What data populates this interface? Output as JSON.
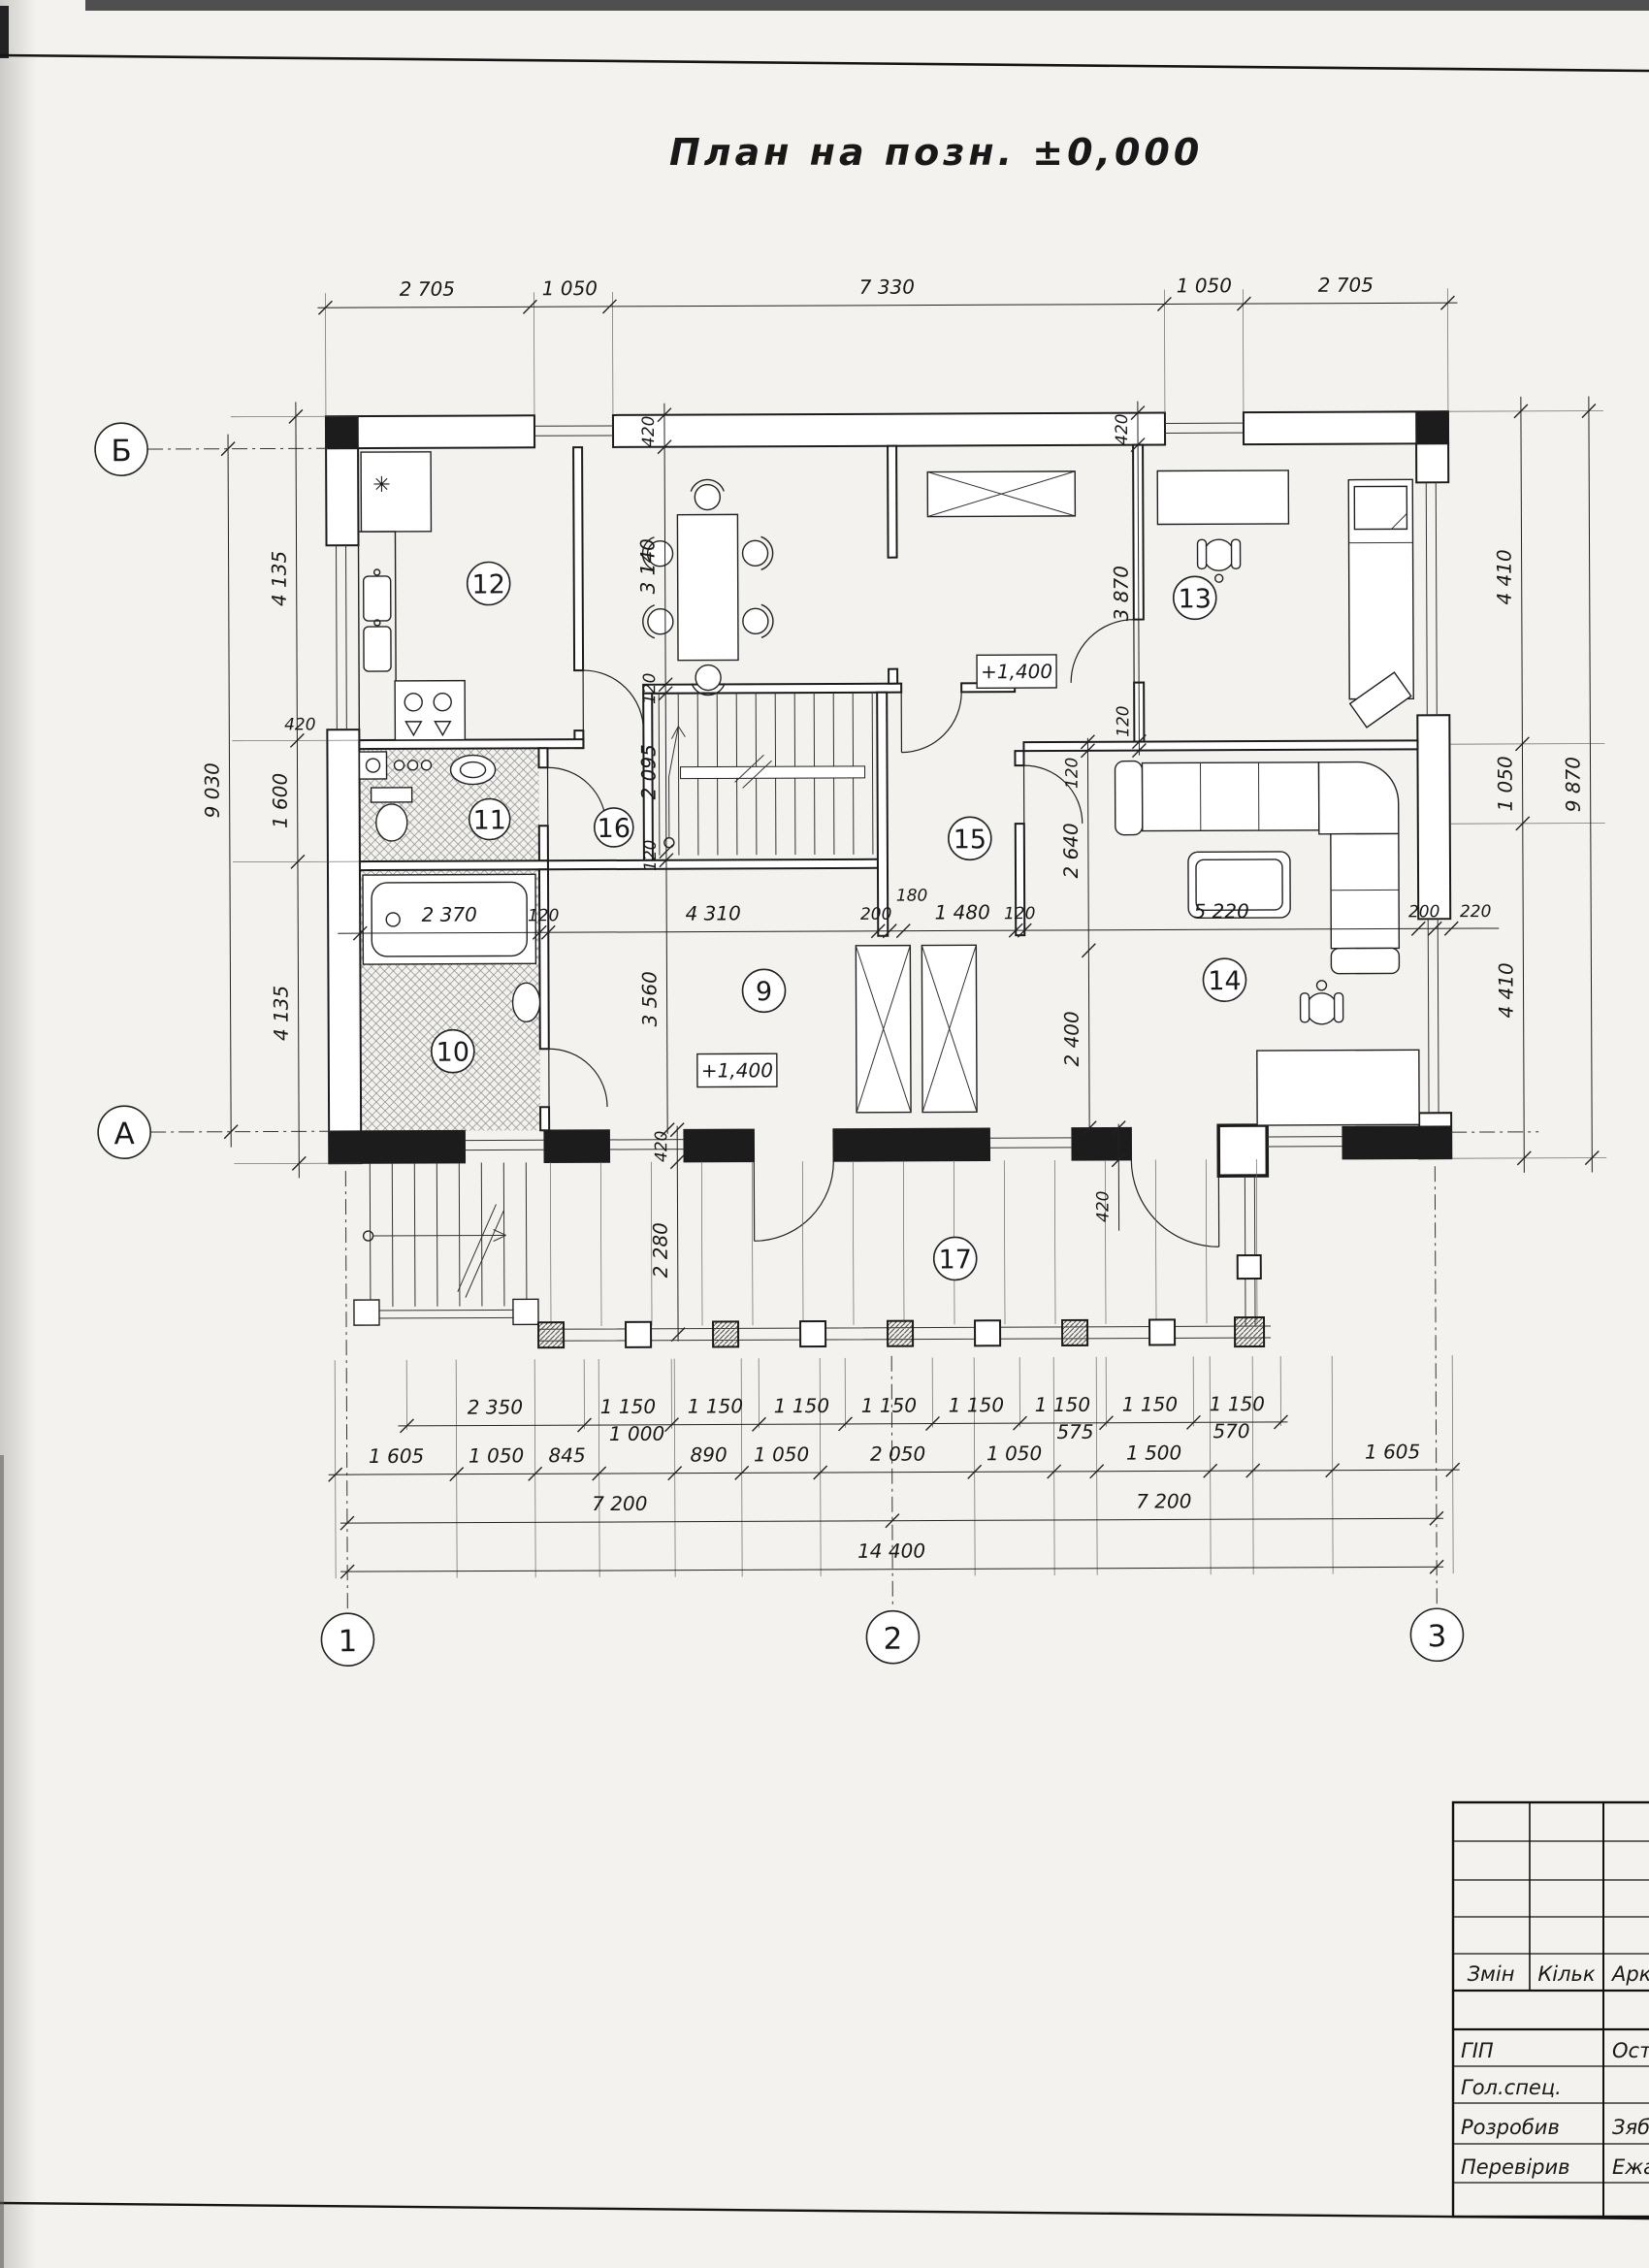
{
  "title": "План на позн. ±0,000",
  "axes": {
    "row": [
      "Б",
      "А"
    ],
    "col": [
      "1",
      "2",
      "3"
    ]
  },
  "rooms": {
    "9": "9",
    "10": "10",
    "11": "11",
    "12": "12",
    "13": "13",
    "14": "14",
    "15": "15",
    "16": "16",
    "17": "17"
  },
  "marks": {
    "level": "+1,400",
    "fridge": "✳"
  },
  "dims": {
    "top": [
      "2 705",
      "1 050",
      "7 330",
      "1 050",
      "2 705"
    ],
    "left": [
      "4 135",
      "1 600",
      "4 135"
    ],
    "left_overall": "9 030",
    "left_wall": "420",
    "right": [
      "4 410",
      "1 050",
      "4 410"
    ],
    "right_overall": "9 870",
    "middle": [
      "2 370",
      "120",
      "4 310",
      "200",
      "180",
      "1 480",
      "120",
      "5 220",
      "200",
      "220"
    ],
    "col_a": [
      "420",
      "3 140",
      "120",
      "2 095",
      "120",
      "3 560"
    ],
    "col_b": [
      "420",
      "3 870",
      "120"
    ],
    "col_c": [
      "120",
      "2 640",
      "2 400"
    ],
    "porch": [
      "420",
      "2 280",
      "420"
    ],
    "row_a": [
      "2 350",
      "1 150",
      "1 150",
      "1 150",
      "1 150",
      "1 150",
      "1 150",
      "1 150",
      "1 150"
    ],
    "row_b": [
      "1 605",
      "1 050",
      "845",
      "890",
      "1 050",
      "2 050",
      "1 050",
      "1 500",
      "1 605"
    ],
    "row_b_raised": [
      "1 000",
      "575",
      "570"
    ],
    "row_c": [
      "7 200",
      "7 200"
    ],
    "row_d": "14 400"
  },
  "titleblock": {
    "headers": [
      "Змін",
      "Кільк",
      "Арк"
    ],
    "rows": [
      {
        "label": "ГІП",
        "value": "Ост"
      },
      {
        "label": "Гол.спец.",
        "value": ""
      },
      {
        "label": "Розробив",
        "value": "Зябр"
      },
      {
        "label": "Перевірив",
        "value": "Ежа"
      }
    ]
  }
}
